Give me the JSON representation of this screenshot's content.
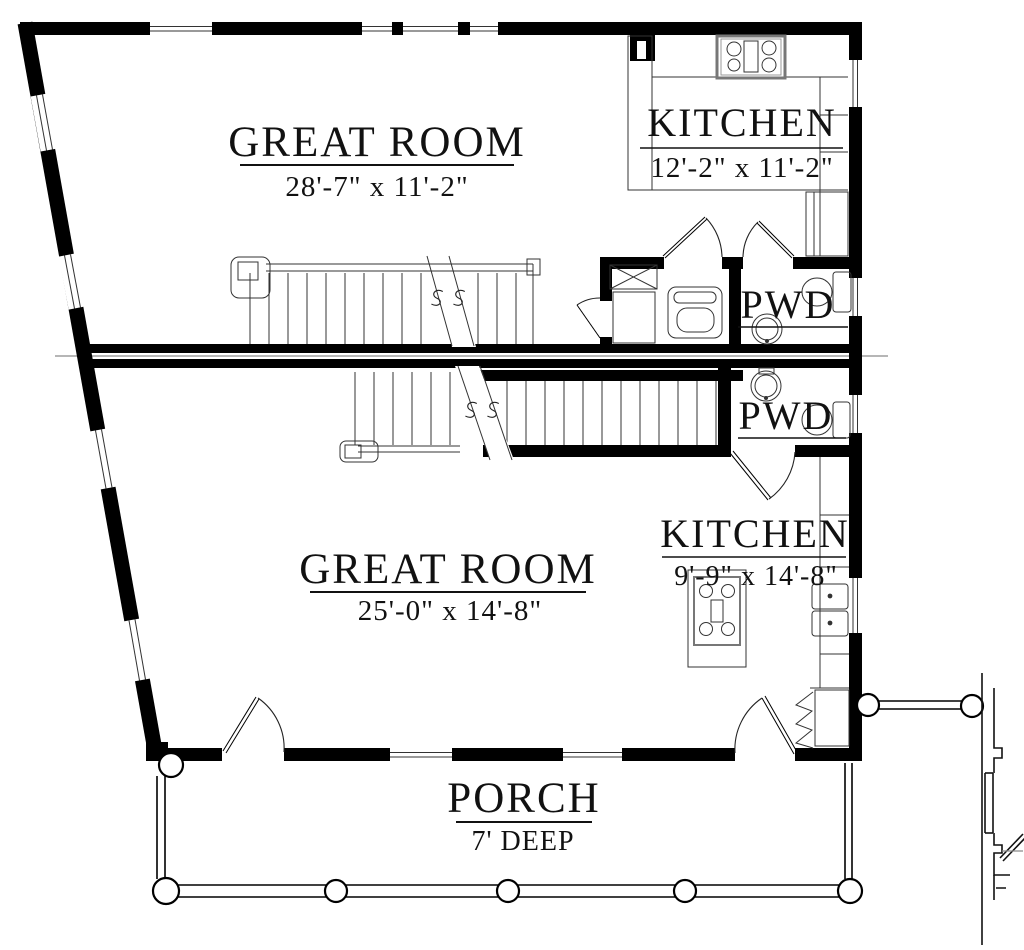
{
  "title": "Two-unit floor plan",
  "colors": {
    "wall": "#000000",
    "line": "#333333",
    "muted": "#8a8a8a"
  },
  "rooms": {
    "great_room_upper": {
      "name": "GREAT ROOM",
      "dims": "28'-7\" x 11'-2\""
    },
    "kitchen_upper": {
      "name": "KITCHEN",
      "dims": "12'-2\" x 11'-2\""
    },
    "pwd_upper": {
      "name": "PWD"
    },
    "pwd_lower": {
      "name": "PWD"
    },
    "great_room_lower": {
      "name": "GREAT ROOM",
      "dims": "25'-0\" x 14'-8\""
    },
    "kitchen_lower": {
      "name": "KITCHEN",
      "dims": "9'-9\" x 14'-8\""
    },
    "porch": {
      "name": "PORCH",
      "dims": "7' DEEP"
    }
  }
}
